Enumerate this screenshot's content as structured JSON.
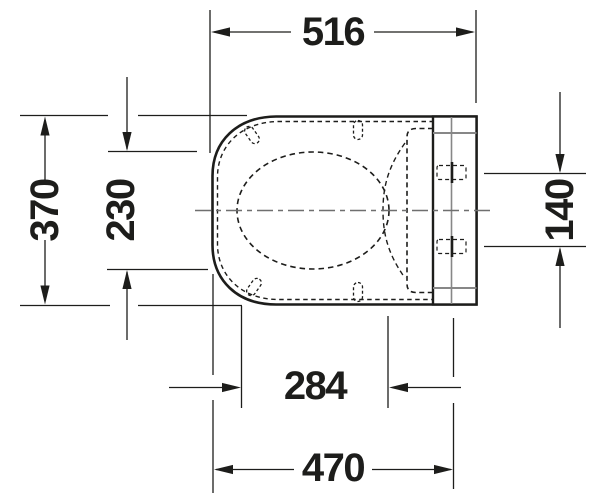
{
  "page": {
    "background": "#ffffff"
  },
  "drawing": {
    "kind": "technical dimension drawing",
    "subject": "toilet seat and cover, top view",
    "units": "mm",
    "line_color": "#1d1d1b",
    "secondary_line_color": "#878787",
    "dimensions": [
      {
        "id": "overall-depth",
        "value": "516",
        "orientation": "horizontal",
        "position": "top"
      },
      {
        "id": "overall-width",
        "value": "370",
        "orientation": "vertical",
        "position": "left-outer"
      },
      {
        "id": "seat-opening-width",
        "value": "230",
        "orientation": "vertical",
        "position": "left-inner"
      },
      {
        "id": "hinge-hole-spacing",
        "value": "140",
        "orientation": "vertical",
        "position": "right"
      },
      {
        "id": "bumper-span",
        "value": "284",
        "orientation": "horizontal",
        "position": "bottom-inner"
      },
      {
        "id": "front-to-hinge-holes",
        "value": "470",
        "orientation": "horizontal",
        "position": "bottom-outer"
      }
    ]
  }
}
